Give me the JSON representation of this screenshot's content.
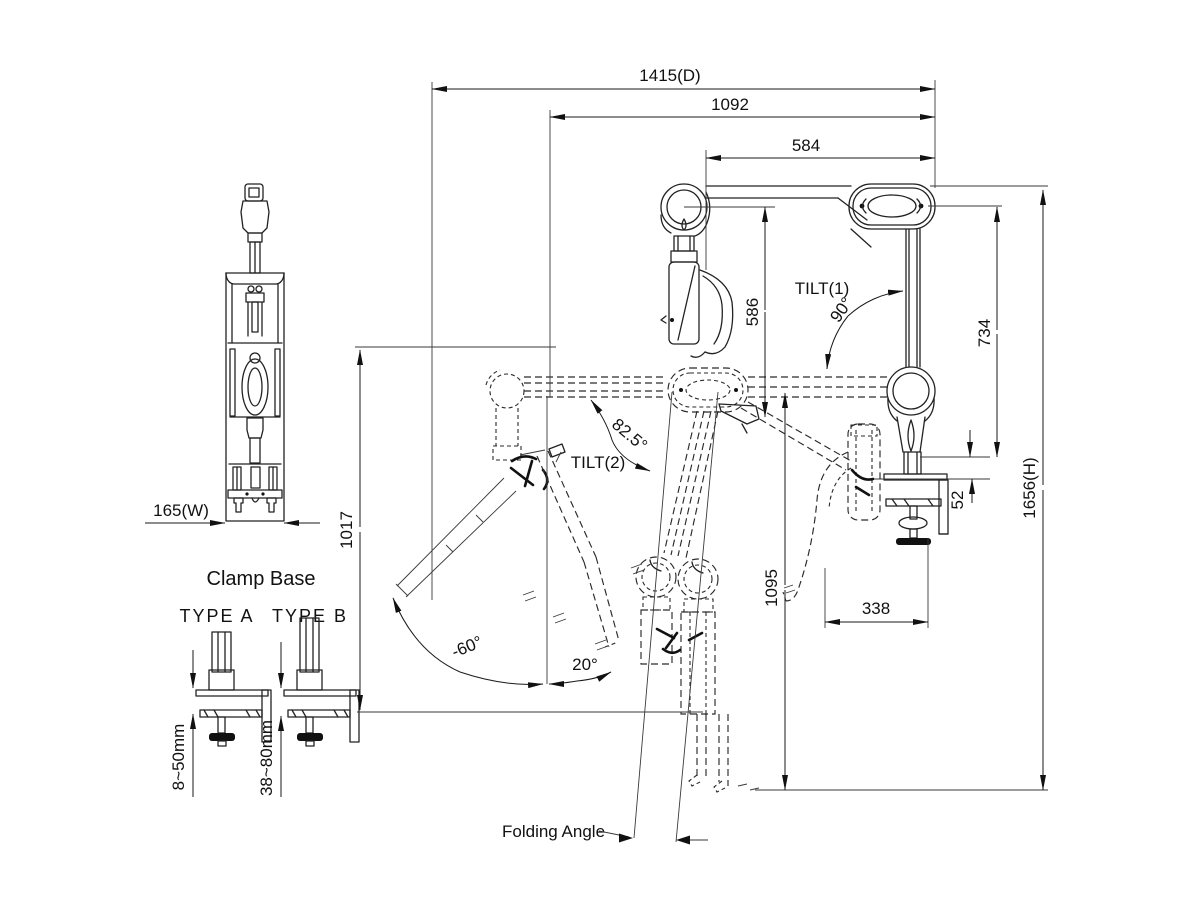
{
  "drawing": {
    "background": "#ffffff",
    "line_color": "#222222",
    "dims": {
      "d1415": "1415(D)",
      "d1092": "1092",
      "d584": "584",
      "d586": "586",
      "d734": "734",
      "d1656": "1656(H)",
      "d1095": "1095",
      "d1017": "1017",
      "d338": "338",
      "d52": "52",
      "d165": "165(W)"
    },
    "angles": {
      "tilt1_label": "TILT(1)",
      "tilt1_value": "90°",
      "tilt2_label": "TILT(2)",
      "tilt2_value": "82.5°",
      "tilt_down": "-60°",
      "tilt_up": "20°",
      "folding": "Folding Angle"
    },
    "clamp_base": {
      "title": "Clamp Base",
      "type_a_label": "TYPE A",
      "type_a_range": "8~50mm",
      "type_b_label": "TYPE B",
      "type_b_range": "38~80mm"
    }
  }
}
